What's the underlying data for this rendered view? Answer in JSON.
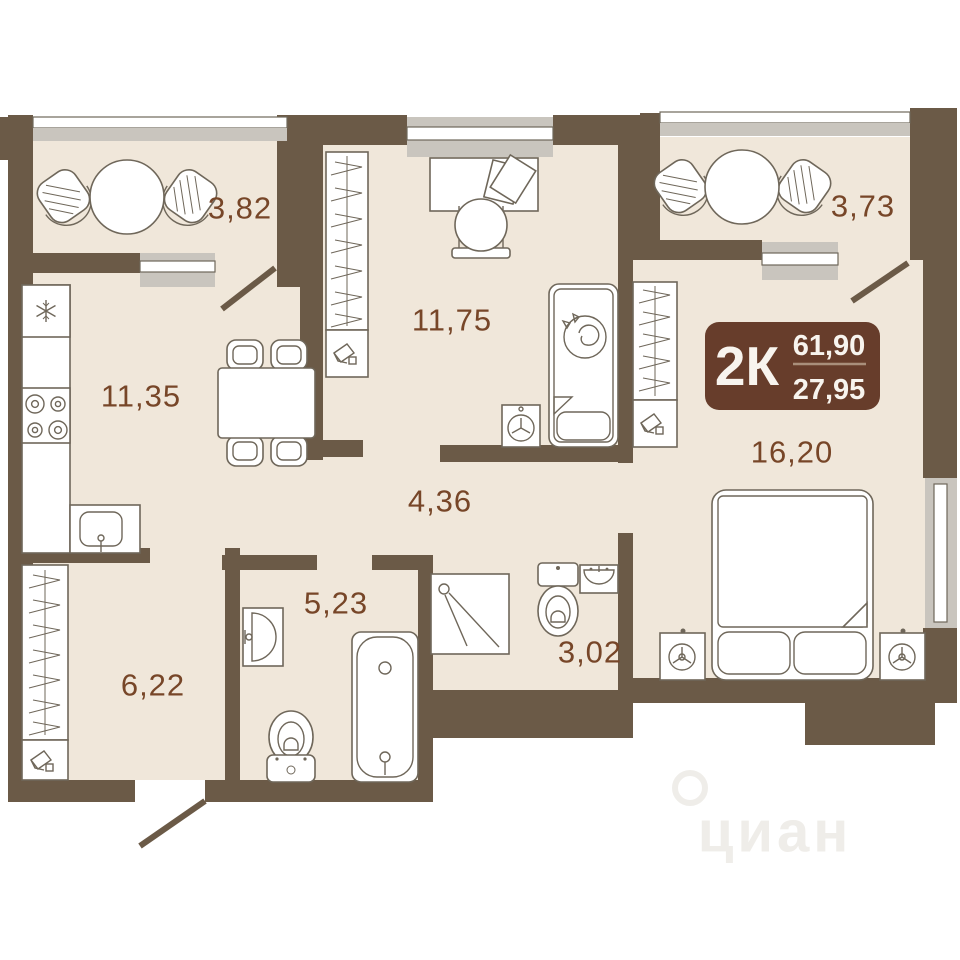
{
  "plan": {
    "badge": {
      "type": "2К",
      "area_total": "61,90",
      "area_living": "27,95"
    },
    "rooms": [
      {
        "name": "balcony-left",
        "area": "3,82"
      },
      {
        "name": "living-room",
        "area": "11,75"
      },
      {
        "name": "balcony-right",
        "area": "3,73"
      },
      {
        "name": "kitchen",
        "area": "11,35"
      },
      {
        "name": "bedroom",
        "area": "16,20"
      },
      {
        "name": "hallway",
        "area": "4,36"
      },
      {
        "name": "bathroom",
        "area": "5,23"
      },
      {
        "name": "entry-hall",
        "area": "6,22"
      },
      {
        "name": "wc",
        "area": "3,02"
      }
    ],
    "watermark": "циан",
    "icons": {
      "fridge": "snowflake",
      "stove": "four-burners",
      "washing-machine": "drum-circle",
      "nightstand-lamp": "three-spoke-circle",
      "wardrobe": "hanger-rail",
      "shoe-box": "boot-in-box"
    },
    "colors": {
      "wall": "#6b5a47",
      "floor": "#f0e7da",
      "window": "#c9c5be",
      "furniture_stroke": "#6f675a",
      "label": "#774628",
      "badge_bg": "#673d2b",
      "badge_text": "#f8f4ee",
      "badge_divider": "#a98f7b"
    }
  }
}
